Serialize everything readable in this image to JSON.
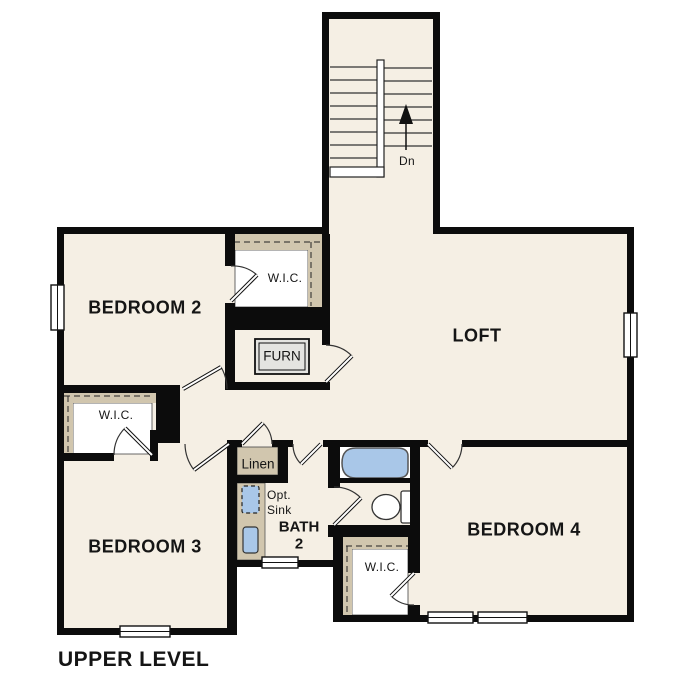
{
  "plan": {
    "title": "UPPER LEVEL",
    "rooms": {
      "bedroom2": "BEDROOM 2",
      "bedroom3": "BEDROOM 3",
      "bedroom4": "BEDROOM 4",
      "loft": "LOFT",
      "bath_line1": "BATH",
      "bath_line2": "2",
      "wic2": "W.I.C.",
      "wic3": "W.I.C.",
      "wic4": "W.I.C.",
      "linen": "Linen",
      "furnace": "FURN",
      "opt_sink_line1": "Opt.",
      "opt_sink_line2": "Sink",
      "stairs_direction": "Dn"
    },
    "colors": {
      "background": "#ffffff",
      "floor": "#f5efe4",
      "wall": "#0c0c0c",
      "closet_shading": "#d1c6ae",
      "fixture_blue": "#a9c7e8"
    }
  }
}
